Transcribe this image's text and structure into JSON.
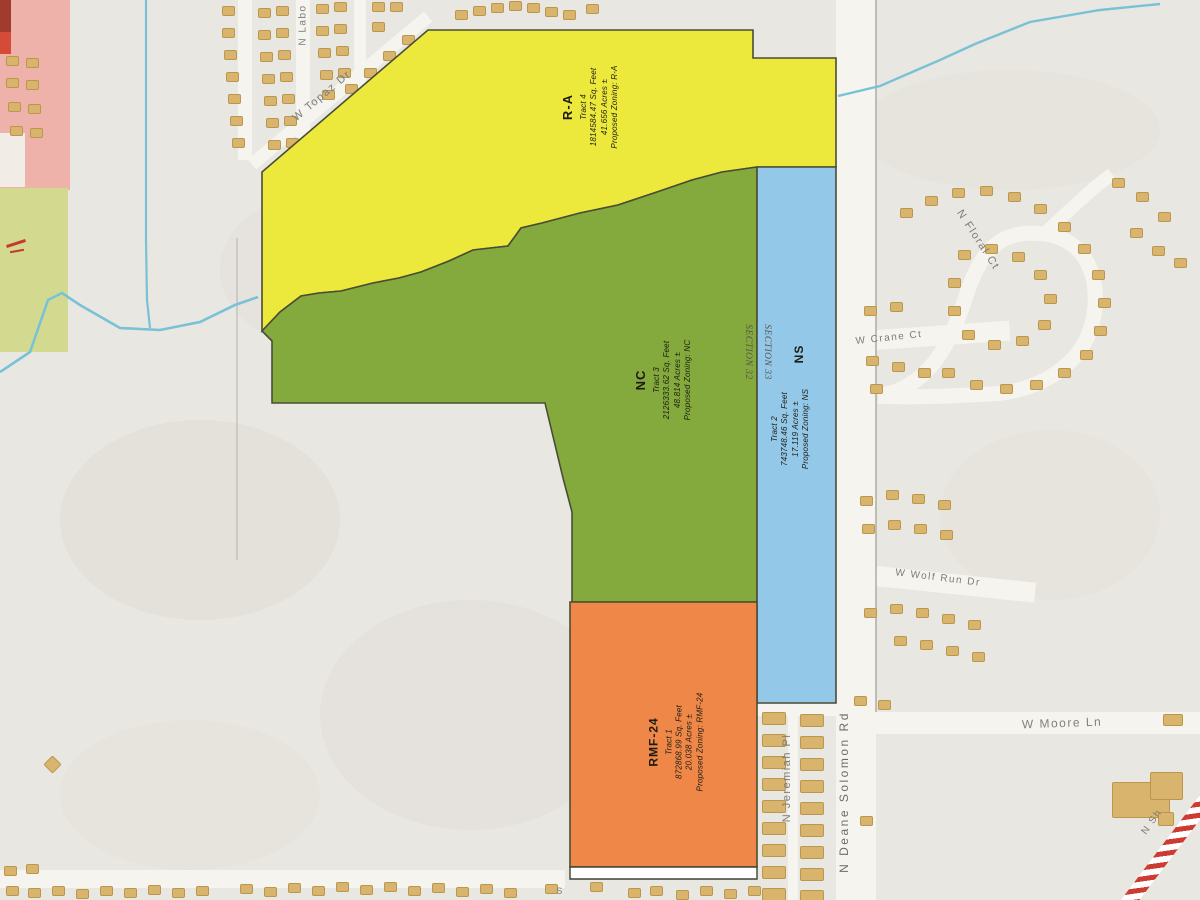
{
  "map": {
    "type": "zoning-plat-map",
    "parcels": [
      {
        "zone": "R-A",
        "title": "R-A",
        "lines": [
          "Tract 4",
          "1814584.47 Sq. Feet",
          "41.656 Acres ±",
          "Proposed Zoning: R-A"
        ],
        "fill": "#ece93c"
      },
      {
        "zone": "NC",
        "title": "NC",
        "lines": [
          "Tract 3",
          "2126333.62 Sq. Feet",
          "48.814 Acres ±",
          "Proposed Zoning: NC"
        ],
        "fill": "#84a93c"
      },
      {
        "zone": "NS",
        "title": "NS",
        "lines": [
          "Tract 2",
          "743748.46 Sq. Feet",
          "17.119 Acres ±",
          "Proposed Zoning: NS"
        ],
        "fill": "#93c8e9"
      },
      {
        "zone": "RMF-24",
        "title": "RMF-24",
        "lines": [
          "Tract 1",
          "872868.99 Sq. Feet",
          "20.038 Acres ±",
          "Proposed Zoning: RMF-24"
        ],
        "fill": "#ee8747"
      }
    ],
    "section_labels": {
      "west": "SECTION 32",
      "east": "SECTION 33"
    },
    "street_labels": {
      "n_labo": "N Labo",
      "w_topaz": "W Topaz Dr",
      "n_floral": "N Floral Ct",
      "w_crane": "W Crane Ct",
      "w_wolf_run": "W Wolf Run Dr",
      "w_moore": "W Moore Ln",
      "n_jeremiah": "N Jeremiah Pl",
      "n_deane_solomon": "N Deane Solomon Rd",
      "n_sh": "N Sh",
      "bottom_partial": "S"
    },
    "colors": {
      "creek": "#79c2d6",
      "parcel_border": "#4a4d35",
      "house": "#d8b46c",
      "pink_zone": "#eeb2aa",
      "green_zone": "#d3da8f",
      "striped_road_red": "#cd3b31"
    },
    "houses": [
      [
        6,
        56
      ],
      [
        26,
        58
      ],
      [
        6,
        78
      ],
      [
        26,
        80
      ],
      [
        8,
        102
      ],
      [
        28,
        104
      ],
      [
        10,
        126
      ],
      [
        30,
        128
      ],
      [
        222,
        6
      ],
      [
        222,
        28
      ],
      [
        224,
        50
      ],
      [
        226,
        72
      ],
      [
        228,
        94
      ],
      [
        230,
        116
      ],
      [
        232,
        138
      ],
      [
        258,
        8
      ],
      [
        258,
        30
      ],
      [
        260,
        52
      ],
      [
        262,
        74
      ],
      [
        264,
        96
      ],
      [
        266,
        118
      ],
      [
        268,
        140
      ],
      [
        276,
        6
      ],
      [
        276,
        28
      ],
      [
        278,
        50
      ],
      [
        280,
        72
      ],
      [
        282,
        94
      ],
      [
        284,
        116
      ],
      [
        286,
        138
      ],
      [
        316,
        4
      ],
      [
        316,
        26
      ],
      [
        318,
        48
      ],
      [
        320,
        70
      ],
      [
        322,
        90
      ],
      [
        334,
        2
      ],
      [
        334,
        24
      ],
      [
        336,
        46
      ],
      [
        338,
        68
      ],
      [
        372,
        2
      ],
      [
        372,
        22
      ],
      [
        390,
        2
      ],
      [
        345,
        84
      ],
      [
        364,
        68
      ],
      [
        383,
        51
      ],
      [
        402,
        35
      ],
      [
        455,
        10
      ],
      [
        473,
        6
      ],
      [
        491,
        3
      ],
      [
        509,
        1
      ],
      [
        527,
        3
      ],
      [
        545,
        7
      ],
      [
        563,
        10
      ],
      [
        586,
        4
      ],
      [
        900,
        208
      ],
      [
        925,
        196
      ],
      [
        952,
        188
      ],
      [
        980,
        186
      ],
      [
        1008,
        192
      ],
      [
        1034,
        204
      ],
      [
        1058,
        222
      ],
      [
        1078,
        244
      ],
      [
        1092,
        270
      ],
      [
        1098,
        298
      ],
      [
        1094,
        326
      ],
      [
        1080,
        350
      ],
      [
        1058,
        368
      ],
      [
        1030,
        380
      ],
      [
        1000,
        384
      ],
      [
        970,
        380
      ],
      [
        942,
        368
      ],
      [
        958,
        250
      ],
      [
        985,
        244
      ],
      [
        1012,
        252
      ],
      [
        1034,
        270
      ],
      [
        1044,
        294
      ],
      [
        1038,
        320
      ],
      [
        1016,
        336
      ],
      [
        988,
        340
      ],
      [
        962,
        330
      ],
      [
        948,
        306
      ],
      [
        948,
        278
      ],
      [
        1112,
        178
      ],
      [
        1136,
        192
      ],
      [
        1158,
        212
      ],
      [
        1130,
        228
      ],
      [
        1152,
        246
      ],
      [
        1174,
        258
      ],
      [
        864,
        306
      ],
      [
        890,
        302
      ],
      [
        866,
        356
      ],
      [
        892,
        362
      ],
      [
        918,
        368
      ],
      [
        870,
        384
      ],
      [
        860,
        496
      ],
      [
        886,
        490
      ],
      [
        912,
        494
      ],
      [
        938,
        500
      ],
      [
        862,
        524
      ],
      [
        888,
        520
      ],
      [
        914,
        524
      ],
      [
        940,
        530
      ],
      [
        864,
        608
      ],
      [
        890,
        604
      ],
      [
        916,
        608
      ],
      [
        942,
        614
      ],
      [
        968,
        620
      ],
      [
        894,
        636
      ],
      [
        920,
        640
      ],
      [
        946,
        646
      ],
      [
        972,
        652
      ],
      [
        854,
        696
      ],
      [
        878,
        700
      ],
      [
        860,
        816
      ],
      [
        762,
        712,
        24,
        13
      ],
      [
        762,
        734,
        24,
        13
      ],
      [
        762,
        756,
        24,
        13
      ],
      [
        762,
        778,
        24,
        13
      ],
      [
        762,
        800,
        24,
        13
      ],
      [
        762,
        822,
        24,
        13
      ],
      [
        762,
        844,
        24,
        13
      ],
      [
        762,
        866,
        24,
        13
      ],
      [
        762,
        888,
        24,
        13
      ],
      [
        800,
        714,
        24,
        13
      ],
      [
        800,
        736,
        24,
        13
      ],
      [
        800,
        758,
        24,
        13
      ],
      [
        800,
        780,
        24,
        13
      ],
      [
        800,
        802,
        24,
        13
      ],
      [
        800,
        824,
        24,
        13
      ],
      [
        800,
        846,
        24,
        13
      ],
      [
        800,
        868,
        24,
        13
      ],
      [
        800,
        890,
        24,
        13
      ],
      [
        1112,
        782,
        58,
        36
      ],
      [
        1150,
        772,
        33,
        28
      ],
      [
        1158,
        812,
        16,
        14
      ],
      [
        1163,
        714,
        20,
        12
      ],
      [
        4,
        866
      ],
      [
        26,
        864
      ],
      [
        6,
        886
      ],
      [
        28,
        888
      ],
      [
        52,
        886
      ],
      [
        76,
        889
      ],
      [
        100,
        886
      ],
      [
        124,
        888
      ],
      [
        148,
        885
      ],
      [
        172,
        888
      ],
      [
        196,
        886
      ],
      [
        240,
        884
      ],
      [
        264,
        887
      ],
      [
        288,
        883
      ],
      [
        312,
        886
      ],
      [
        336,
        882
      ],
      [
        360,
        885
      ],
      [
        384,
        882
      ],
      [
        408,
        886
      ],
      [
        432,
        883
      ],
      [
        456,
        887
      ],
      [
        480,
        884
      ],
      [
        504,
        888
      ],
      [
        545,
        884
      ],
      [
        590,
        882
      ],
      [
        628,
        888
      ],
      [
        650,
        886
      ],
      [
        676,
        890
      ],
      [
        700,
        886
      ],
      [
        724,
        889
      ],
      [
        748,
        886
      ],
      [
        46,
        758,
        13,
        13,
        45
      ]
    ]
  }
}
